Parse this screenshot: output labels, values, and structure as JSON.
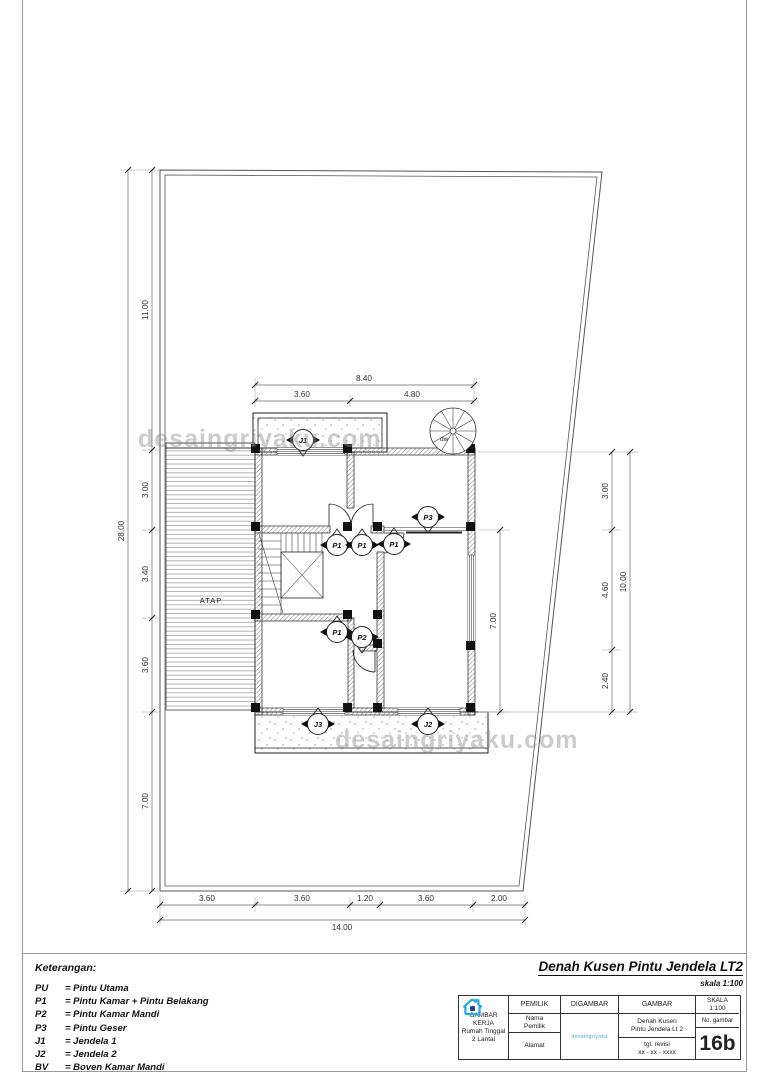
{
  "page": {
    "watermark": "desaingriyaku.com"
  },
  "drawing": {
    "title": "Denah Kusen Pintu Jendela LT2",
    "scale_note": "skala 1:100",
    "atap_label": "ATAP",
    "spiral_stair_label": "dw",
    "markers": {
      "j1": "J1",
      "j2": "J2",
      "j3": "J3",
      "p1": "P1",
      "p2": "P2",
      "p3": "P3"
    },
    "dims": {
      "top_total": "8.40",
      "top_left": "3.60",
      "top_right": "4.80",
      "left_total": "28.00",
      "left_chain": [
        "11.00",
        "3.00",
        "3.40",
        "3.60",
        "7.00"
      ],
      "right_total": "10.00",
      "right_chain": [
        "3.00",
        "4.60",
        "2.40"
      ],
      "mid_right": "7.00",
      "bottom_total": "14.00",
      "bottom_chain": [
        "3.60",
        "3.60",
        "1.20",
        "3.60",
        "2.00"
      ]
    }
  },
  "legend": {
    "title": "Keterangan:",
    "items": [
      {
        "code": "PU",
        "def": "= Pintu Utama"
      },
      {
        "code": "P1",
        "def": "= Pintu Kamar + Pintu Belakang"
      },
      {
        "code": "P2",
        "def": "= Pintu Kamar Mandi"
      },
      {
        "code": "P3",
        "def": "= Pintu Geser"
      },
      {
        "code": "J1",
        "def": "= Jendela 1"
      },
      {
        "code": "J2",
        "def": "= Jendela 2"
      },
      {
        "code": "BV",
        "def": "= Boven Kamar Mandi"
      }
    ]
  },
  "title_block": {
    "project": [
      "GAMBAR KERJA",
      "Rumah Tinggal",
      "2 Lantai"
    ],
    "pemilik_header": "PEMILIK",
    "nama": [
      "Nama",
      "Pemilik"
    ],
    "alamat": "Alamat",
    "digambar_header": "DIGAMBAR",
    "logo_text": "desaingriyaku",
    "gambar_header": "GAMBAR",
    "gambar_cell": [
      "Denah Kusen",
      "Pintu Jendela Lt 2"
    ],
    "revisi_cell": [
      "tgl. revisi",
      "xx - xx - xxxx"
    ],
    "skala": [
      "SKALA",
      "1:100"
    ],
    "no_gambar_label": "No. gambar",
    "sheet_number": "16b",
    "accent_color": "#29abe2"
  }
}
